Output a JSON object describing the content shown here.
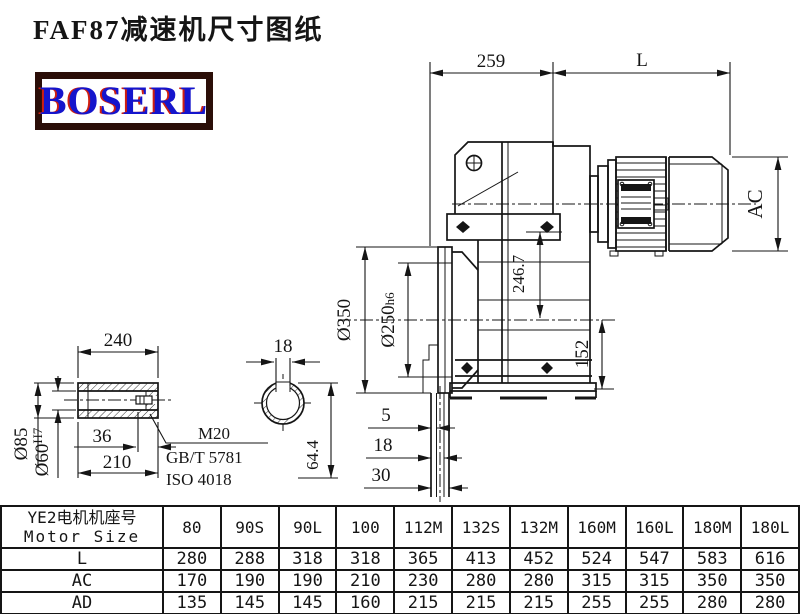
{
  "page": {
    "title": "FAF87减速机尺寸图纸",
    "logo_text": "BOSERL"
  },
  "colors": {
    "line": "#151515",
    "logo_border": "#2b0e08",
    "logo_text": "#1515cc",
    "logo_shadow": "#cf1f10",
    "background": "#ffffff"
  },
  "drawing": {
    "dims": {
      "width_259": "259",
      "motor_length": "L",
      "motor_od": "AC",
      "axis_height": "246.7",
      "flange_od": "Ø350",
      "spigot_d": "Ø250",
      "spigot_fit": "h6",
      "foot_152": "152",
      "step_5": "5",
      "step_18": "18",
      "step_30": "30",
      "shaft_len_240": "240",
      "shaft_od_85": "Ø85",
      "bore_60": "Ø60",
      "bore_fit": "H7",
      "depth_36": "36",
      "len_210": "210",
      "key_width_18": "18",
      "key_height_64_4": "64.4"
    },
    "notes": {
      "thread": "M20",
      "standard_gb": "GB/T 5781",
      "standard_iso": "ISO 4018"
    }
  },
  "table": {
    "header_col1_line1": "YE2电机机座号",
    "header_col1_line2": "Motor Size",
    "columns": [
      "80",
      "90S",
      "90L",
      "100",
      "112M",
      "132S",
      "132M",
      "160M",
      "160L",
      "180M",
      "180L"
    ],
    "rows": [
      {
        "label": "L",
        "values": [
          "280",
          "288",
          "318",
          "318",
          "365",
          "413",
          "452",
          "524",
          "547",
          "583",
          "616"
        ]
      },
      {
        "label": "AC",
        "values": [
          "170",
          "190",
          "190",
          "210",
          "230",
          "280",
          "280",
          "315",
          "315",
          "350",
          "350"
        ]
      },
      {
        "label": "AD",
        "values": [
          "135",
          "145",
          "145",
          "160",
          "215",
          "215",
          "215",
          "255",
          "255",
          "280",
          "280"
        ]
      }
    ]
  }
}
